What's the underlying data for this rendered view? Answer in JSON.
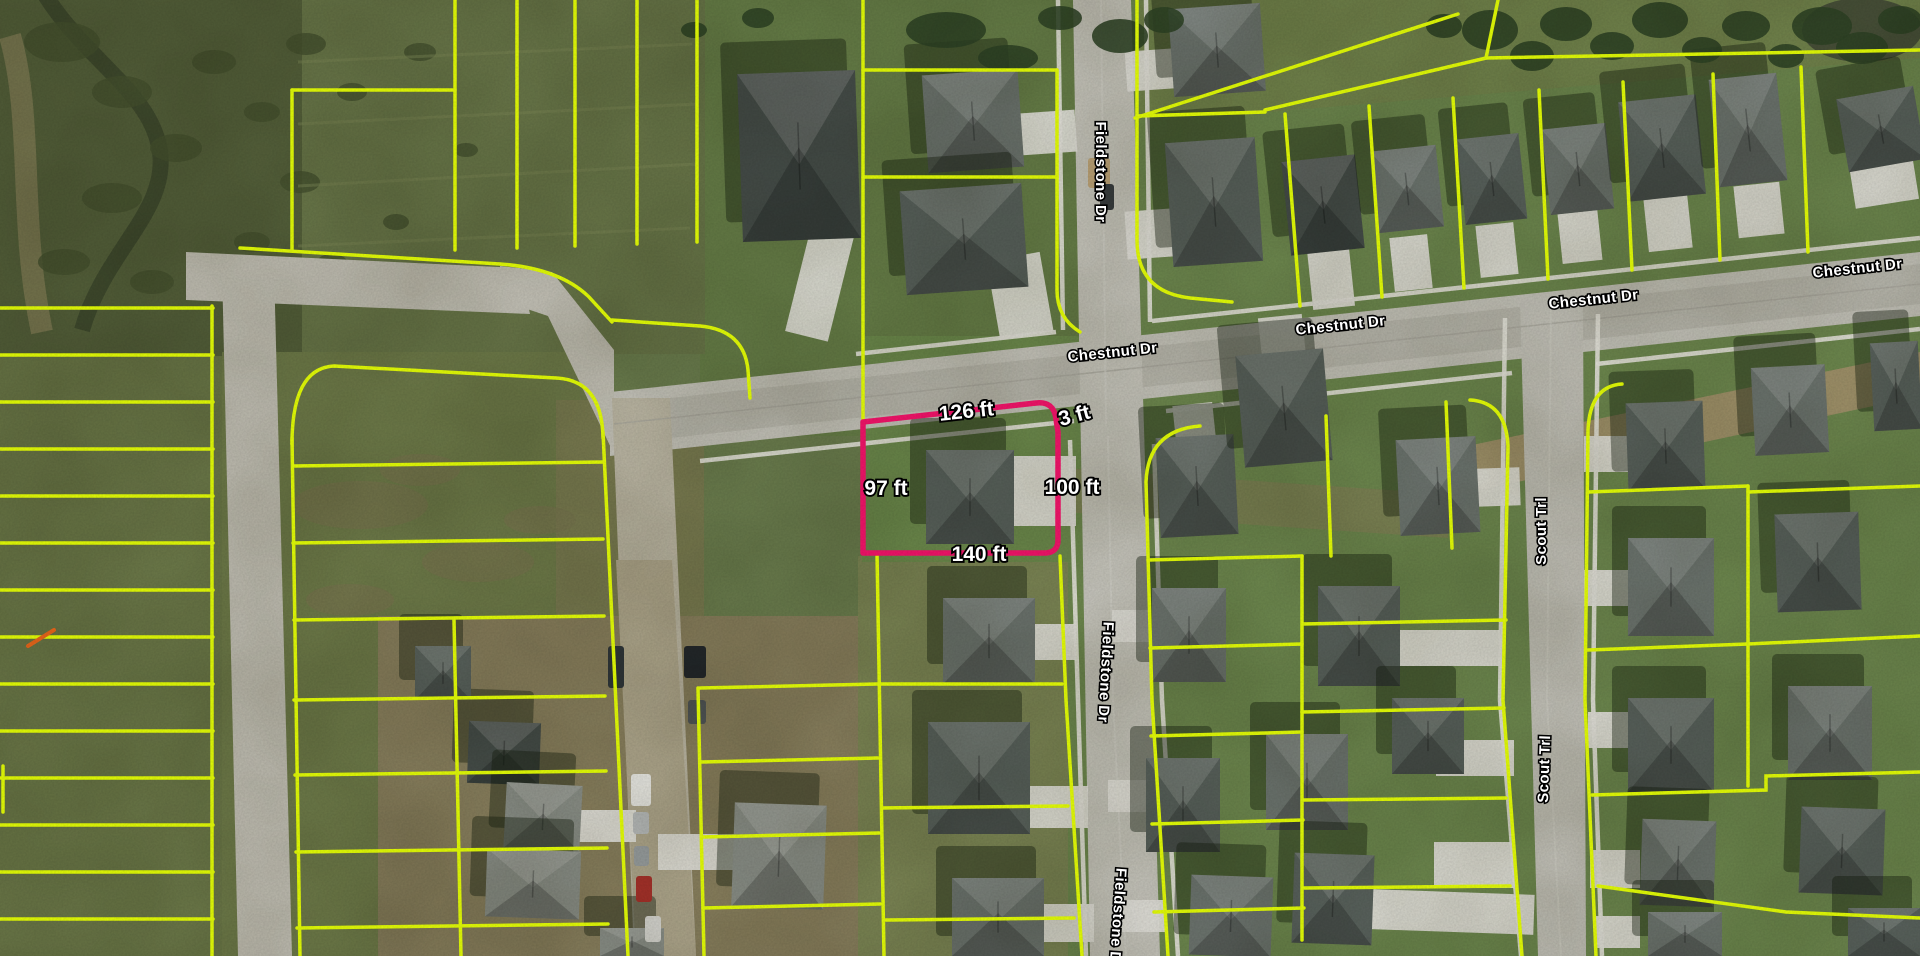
{
  "street_labels": [
    {
      "street": "Chestnut Dr",
      "text": "Chestnut Dr"
    },
    {
      "street": "Chestnut Dr",
      "text": "Chestnut Dr"
    },
    {
      "street": "Chestnut Dr",
      "text": "Chestnut Dr"
    },
    {
      "street": "Chestnut Dr",
      "text": "Chestnut Dr"
    },
    {
      "street": "Fieldstone Dr",
      "text": "Fieldstone Dr"
    },
    {
      "street": "Fieldstone Dr",
      "text": "Fieldstone Dr"
    },
    {
      "street": "Fieldstone Dr",
      "text": "Fieldstone Dr"
    },
    {
      "street": "Scout Trl",
      "text": "Scout Trl"
    },
    {
      "street": "Scout Trl",
      "text": "Scout Trl"
    }
  ],
  "selected_parcel": {
    "dimensions": [
      {
        "side": "north",
        "label": "126 ft"
      },
      {
        "side": "northeast-corner",
        "label": "3 ft"
      },
      {
        "side": "west",
        "label": "97 ft"
      },
      {
        "side": "east",
        "label": "100 ft"
      },
      {
        "side": "south",
        "label": "140 ft"
      }
    ]
  },
  "colors": {
    "parcel_boundary_yellow": "#e1fa07",
    "selected_parcel_pink": "#ee1468",
    "street_label_fill": "#ffffff",
    "street_label_outline": "#000000",
    "construction_marker_orange": "#e2641a"
  }
}
